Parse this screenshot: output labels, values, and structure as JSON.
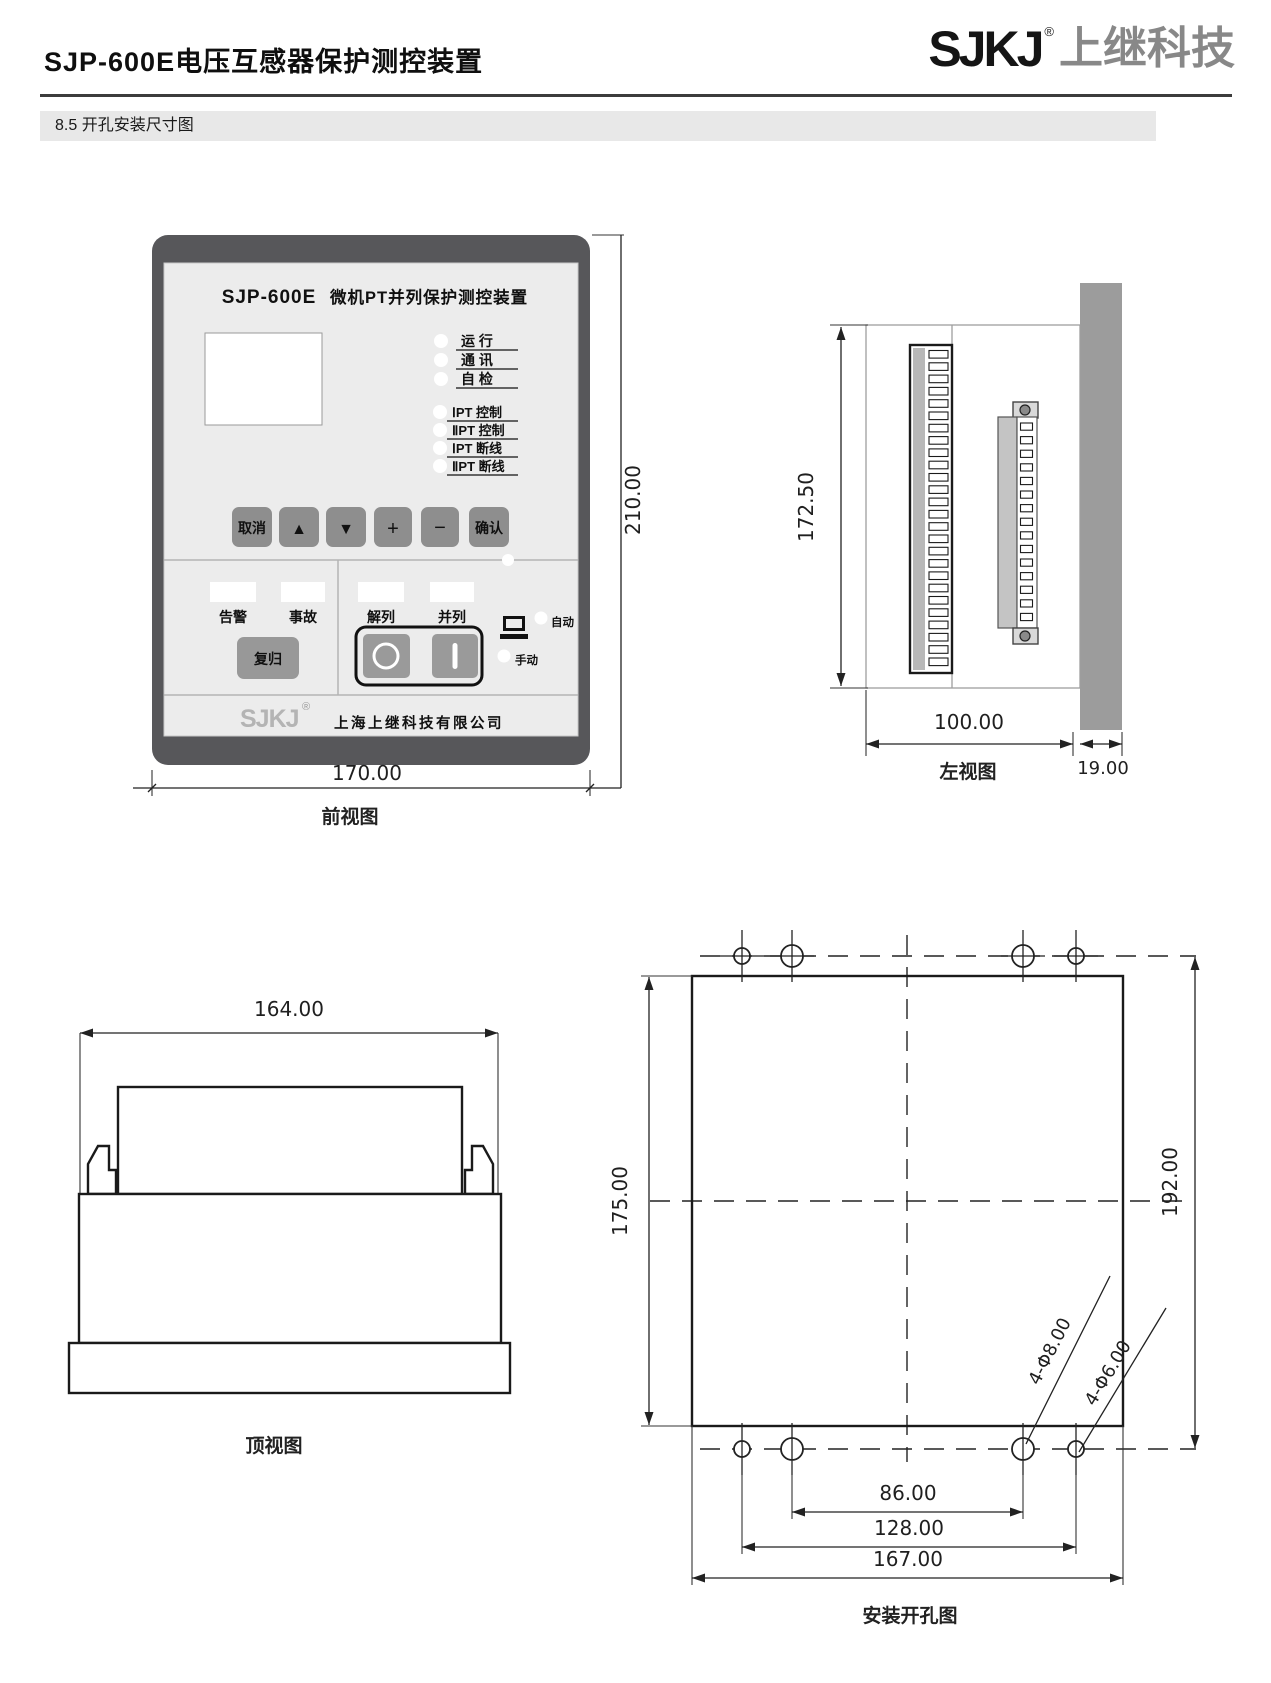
{
  "header": {
    "title": "SJP-600E电压互感器保护测控装置",
    "logo_text": "SJKJ",
    "logo_reg": "®",
    "logo_suffix": "上继科技",
    "section_title": "8.5 开孔安装尺寸图"
  },
  "front_view": {
    "caption": "前视图",
    "model": "SJP-600E",
    "panel_title": "微机PT并列保护测控装置",
    "status_leds": [
      "运 行",
      "通 讯",
      "自 检"
    ],
    "pt_leds": [
      "ⅠPT 控制",
      "ⅡPT 控制",
      "ⅠPT 断线",
      "ⅡPT 断线"
    ],
    "keys": [
      "取消",
      "▲",
      "▼",
      "+",
      "−",
      "确认"
    ],
    "left_windows": [
      "告警",
      "事故"
    ],
    "reset_key": "复归",
    "right_windows": [
      "解列",
      "并列"
    ],
    "switch_off_symbol": "○",
    "switch_on_symbol": "|",
    "auto_label": "自动",
    "manual_label": "手动",
    "brand": "SJKJ",
    "brand_reg": "®",
    "company": "上海上继科技有限公司",
    "dim_height": "210.00",
    "dim_width": "170.00"
  },
  "left_view": {
    "caption": "左视图",
    "dim_height": "172.50",
    "dim_depth": "100.00",
    "dim_panel_thickness": "19.00",
    "terminal_slot_count": 26,
    "connector_slot_count": 15
  },
  "top_view": {
    "caption": "顶视图",
    "dim_width": "164.00"
  },
  "install_view": {
    "caption": "安装开孔图",
    "dim_cutout_height": "175.00",
    "dim_hole_span_vertical": "192.00",
    "dim_hole_span_inner": "86.00",
    "dim_hole_span_outer": "128.00",
    "dim_cutout_width": "167.00",
    "hole_label_inner": "4-Φ8.00",
    "hole_label_outer": "4-Φ6.00"
  }
}
